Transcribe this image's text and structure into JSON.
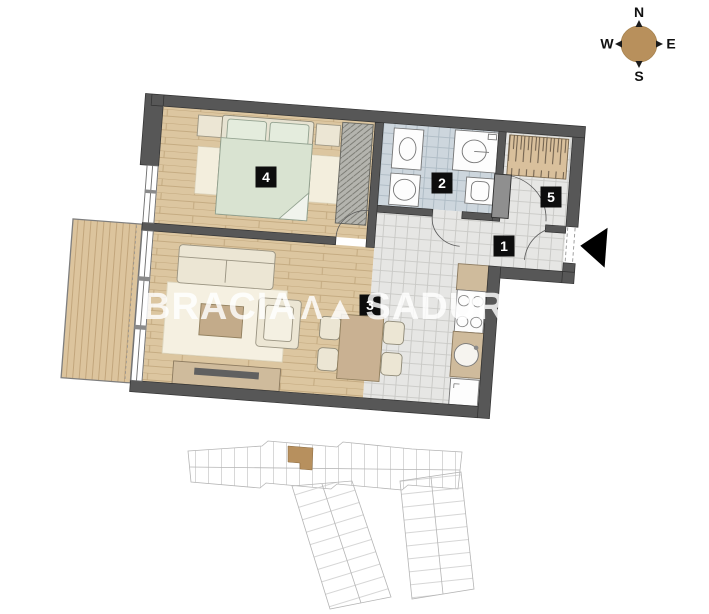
{
  "compass": {
    "n": "N",
    "e": "E",
    "s": "S",
    "w": "W"
  },
  "watermark": {
    "left": "BRACIA",
    "logo": "Λ▲",
    "right": "SADURSCY"
  },
  "room_labels": {
    "hall": "1",
    "bath": "2",
    "living": "3",
    "bedroom": "4",
    "closet": "5"
  },
  "colors": {
    "wall": "#575757",
    "wood_floor": "#dcc6a0",
    "tile_floor": "#e6e6e4",
    "bath_tile": "#cdd6dd",
    "accent_tan": "#b7905e",
    "label_bg": "#0d0d0d",
    "watermark": "rgba(255,255,255,0.82)"
  }
}
